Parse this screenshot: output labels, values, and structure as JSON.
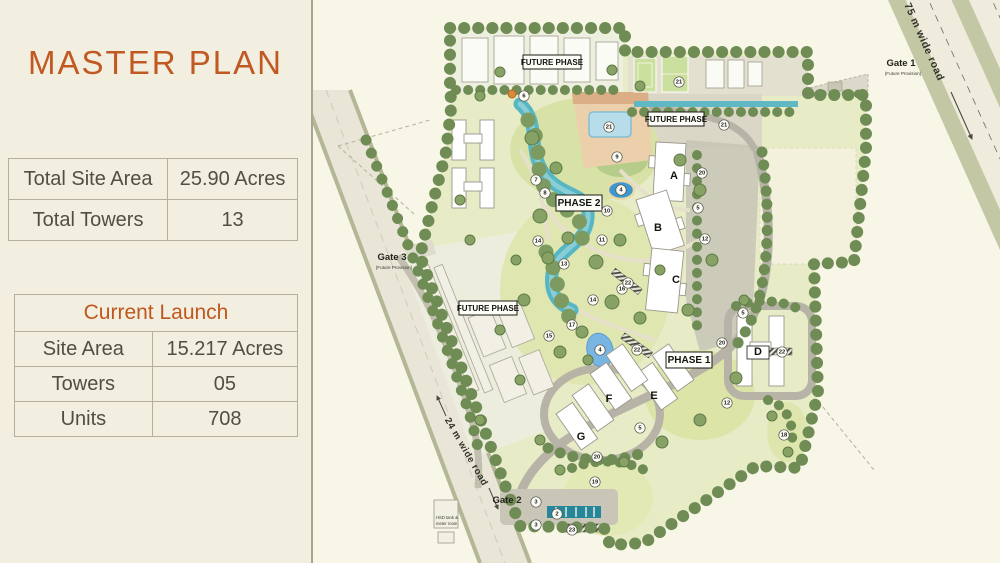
{
  "panel": {
    "title": "MASTER PLAN",
    "summary_table": {
      "rows": [
        {
          "label": "Total Site Area",
          "value": "25.90 Acres"
        },
        {
          "label": "Total Towers",
          "value": "13"
        }
      ]
    },
    "launch_table": {
      "header": "Current Launch",
      "rows": [
        {
          "label": "Site Area",
          "value": "15.217 Acres"
        },
        {
          "label": "Towers",
          "value": "05"
        },
        {
          "label": "Units",
          "value": "708"
        }
      ]
    }
  },
  "colors": {
    "accent_orange": "#c05a22",
    "panel_bg": "#f2efe0",
    "map_bg": "#f8f6e7",
    "water_teal": "#57b6c3",
    "pool_blue": "#b7dcea",
    "lawn_green": "#dfe6b0",
    "tree_green": "#6f8c55",
    "road_gray": "#b7b4a7"
  },
  "map": {
    "phase_labels": [
      {
        "text": "FUTURE PHASE",
        "x": 552,
        "y": 62,
        "w": 58,
        "h": 14,
        "fs": 8
      },
      {
        "text": "FUTURE PHASE",
        "x": 676,
        "y": 119,
        "w": 56,
        "h": 14,
        "fs": 8
      },
      {
        "text": "FUTURE PHASE",
        "x": 488,
        "y": 308,
        "w": 58,
        "h": 14,
        "fs": 8
      },
      {
        "text": "PHASE 2",
        "x": 579,
        "y": 203,
        "w": 46,
        "h": 16,
        "fs": 10
      },
      {
        "text": "PHASE 1",
        "x": 689,
        "y": 360,
        "w": 46,
        "h": 16,
        "fs": 10
      }
    ],
    "gates": [
      {
        "name": "Gate 1",
        "sub": "(Future Provision)",
        "x": 901,
        "y": 66
      },
      {
        "name": "Gate 3",
        "sub": "(Future Provision)",
        "x": 392,
        "y": 260
      },
      {
        "name": "Gate 2",
        "sub": "",
        "x": 507,
        "y": 503
      }
    ],
    "road_labels": [
      {
        "text": "75 m wide road",
        "x": 924,
        "y": 42,
        "angle": 66,
        "fs": 10.5
      },
      {
        "text": "24 m wide road",
        "x": 466,
        "y": 452,
        "angle": 60,
        "fs": 9.5
      }
    ],
    "towers": [
      {
        "id": "A",
        "x": 674,
        "y": 176
      },
      {
        "id": "B",
        "x": 658,
        "y": 228
      },
      {
        "id": "C",
        "x": 676,
        "y": 280
      },
      {
        "id": "D",
        "x": 758,
        "y": 352
      },
      {
        "id": "E",
        "x": 654,
        "y": 396
      },
      {
        "id": "F",
        "x": 609,
        "y": 399
      },
      {
        "id": "G",
        "x": 581,
        "y": 437
      }
    ],
    "markers": [
      {
        "n": "6",
        "x": 524,
        "y": 96
      },
      {
        "n": "21",
        "x": 609,
        "y": 127
      },
      {
        "n": "21",
        "x": 679,
        "y": 82
      },
      {
        "n": "21",
        "x": 724,
        "y": 125
      },
      {
        "n": "9",
        "x": 617,
        "y": 157
      },
      {
        "n": "4",
        "x": 621,
        "y": 190
      },
      {
        "n": "7",
        "x": 536,
        "y": 180
      },
      {
        "n": "8",
        "x": 545,
        "y": 193
      },
      {
        "n": "10",
        "x": 607,
        "y": 211
      },
      {
        "n": "11",
        "x": 602,
        "y": 240
      },
      {
        "n": "14",
        "x": 538,
        "y": 241
      },
      {
        "n": "14",
        "x": 593,
        "y": 300
      },
      {
        "n": "13",
        "x": 564,
        "y": 264
      },
      {
        "n": "16",
        "x": 622,
        "y": 289
      },
      {
        "n": "22",
        "x": 628,
        "y": 283
      },
      {
        "n": "22",
        "x": 637,
        "y": 350
      },
      {
        "n": "22",
        "x": 782,
        "y": 352
      },
      {
        "n": "17",
        "x": 572,
        "y": 325
      },
      {
        "n": "15",
        "x": 549,
        "y": 336
      },
      {
        "n": "20",
        "x": 702,
        "y": 173
      },
      {
        "n": "20",
        "x": 722,
        "y": 343
      },
      {
        "n": "20",
        "x": 597,
        "y": 457
      },
      {
        "n": "5",
        "x": 698,
        "y": 208
      },
      {
        "n": "5",
        "x": 743,
        "y": 313
      },
      {
        "n": "5",
        "x": 640,
        "y": 428
      },
      {
        "n": "12",
        "x": 705,
        "y": 239
      },
      {
        "n": "12",
        "x": 727,
        "y": 403
      },
      {
        "n": "18",
        "x": 784,
        "y": 435
      },
      {
        "n": "19",
        "x": 595,
        "y": 482
      },
      {
        "n": "3",
        "x": 536,
        "y": 502
      },
      {
        "n": "3",
        "x": 536,
        "y": 525
      },
      {
        "n": "2",
        "x": 557,
        "y": 514
      },
      {
        "n": "23",
        "x": 572,
        "y": 530
      },
      {
        "n": "4",
        "x": 600,
        "y": 350
      }
    ],
    "annotations": [
      {
        "text": "HSD tank &",
        "x": 436,
        "y": 519,
        "fs": 4.2
      },
      {
        "text": "meter room",
        "x": 436,
        "y": 525,
        "fs": 4.2
      }
    ]
  }
}
